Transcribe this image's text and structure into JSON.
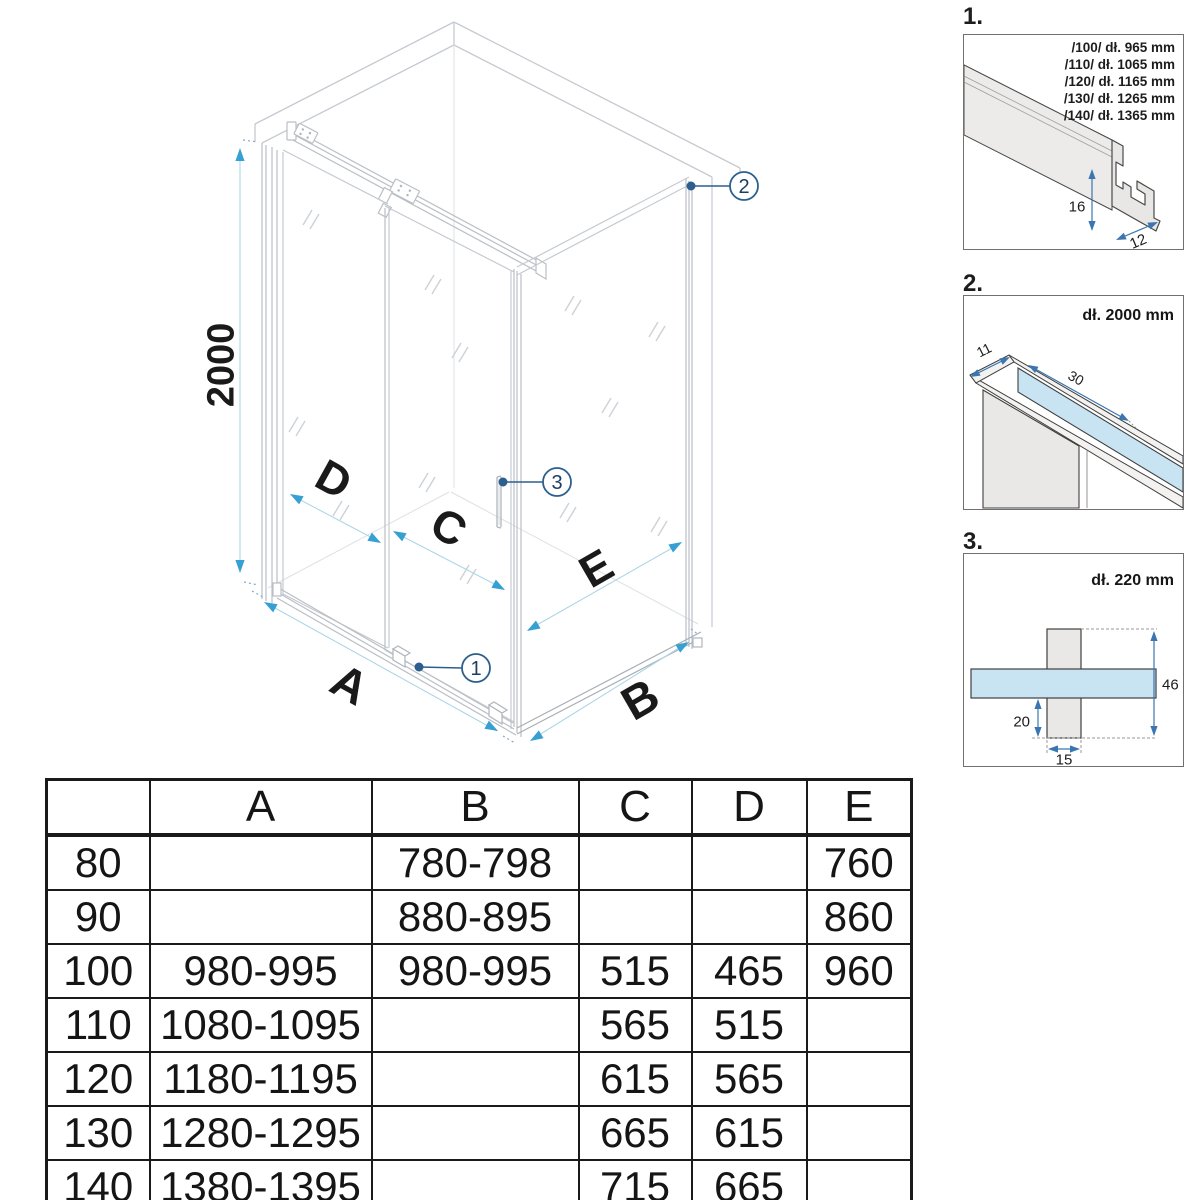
{
  "drawing": {
    "height_label": "2000",
    "dim_labels": {
      "A": "A",
      "B": "B",
      "C": "C",
      "D": "D",
      "E": "E"
    },
    "callouts": [
      "1",
      "2",
      "3"
    ]
  },
  "details": {
    "p1": {
      "label": "1.",
      "lines": [
        "/100/ dł. 965 mm",
        "/110/ dł. 1065 mm",
        "/120/ dł. 1165 mm",
        "/130/ dł. 1265 mm",
        "/140/ dł. 1365 mm"
      ],
      "dim_height": "16",
      "dim_depth": "12"
    },
    "p2": {
      "label": "2.",
      "title": "dł. 2000 mm",
      "dim_width": "11",
      "dim_overlap": "30"
    },
    "p3": {
      "label": "3.",
      "title": "dł. 220 mm",
      "dim_total": "46",
      "dim_bottom": "20",
      "dim_profile": "15"
    }
  },
  "table": {
    "headers": [
      "",
      "A",
      "B",
      "C",
      "D",
      "E"
    ],
    "rows": [
      [
        "80",
        "",
        "780-798",
        "",
        "",
        "760"
      ],
      [
        "90",
        "",
        "880-895",
        "",
        "",
        "860"
      ],
      [
        "100",
        "980-995",
        "980-995",
        "515",
        "465",
        "960"
      ],
      [
        "110",
        "1080-1095",
        "",
        "565",
        "515",
        ""
      ],
      [
        "120",
        "1180-1195",
        "",
        "615",
        "565",
        ""
      ],
      [
        "130",
        "1280-1295",
        "",
        "665",
        "615",
        ""
      ],
      [
        "140",
        "1380-1395",
        "",
        "715",
        "665",
        ""
      ]
    ]
  },
  "colors": {
    "line_gray": "#c5cad0",
    "profile_gray": "#b9bfc5",
    "dim_blue_line": "#aed6e8",
    "dim_blue_arrow": "#36a0d2",
    "callout_blue": "#2d5f8e",
    "detail_arrow_blue": "#3b76b0",
    "glass_blue_fill": "#c8e3f1",
    "profile_fill": "#e9e7e5",
    "table_line": "#1a1a1a"
  }
}
